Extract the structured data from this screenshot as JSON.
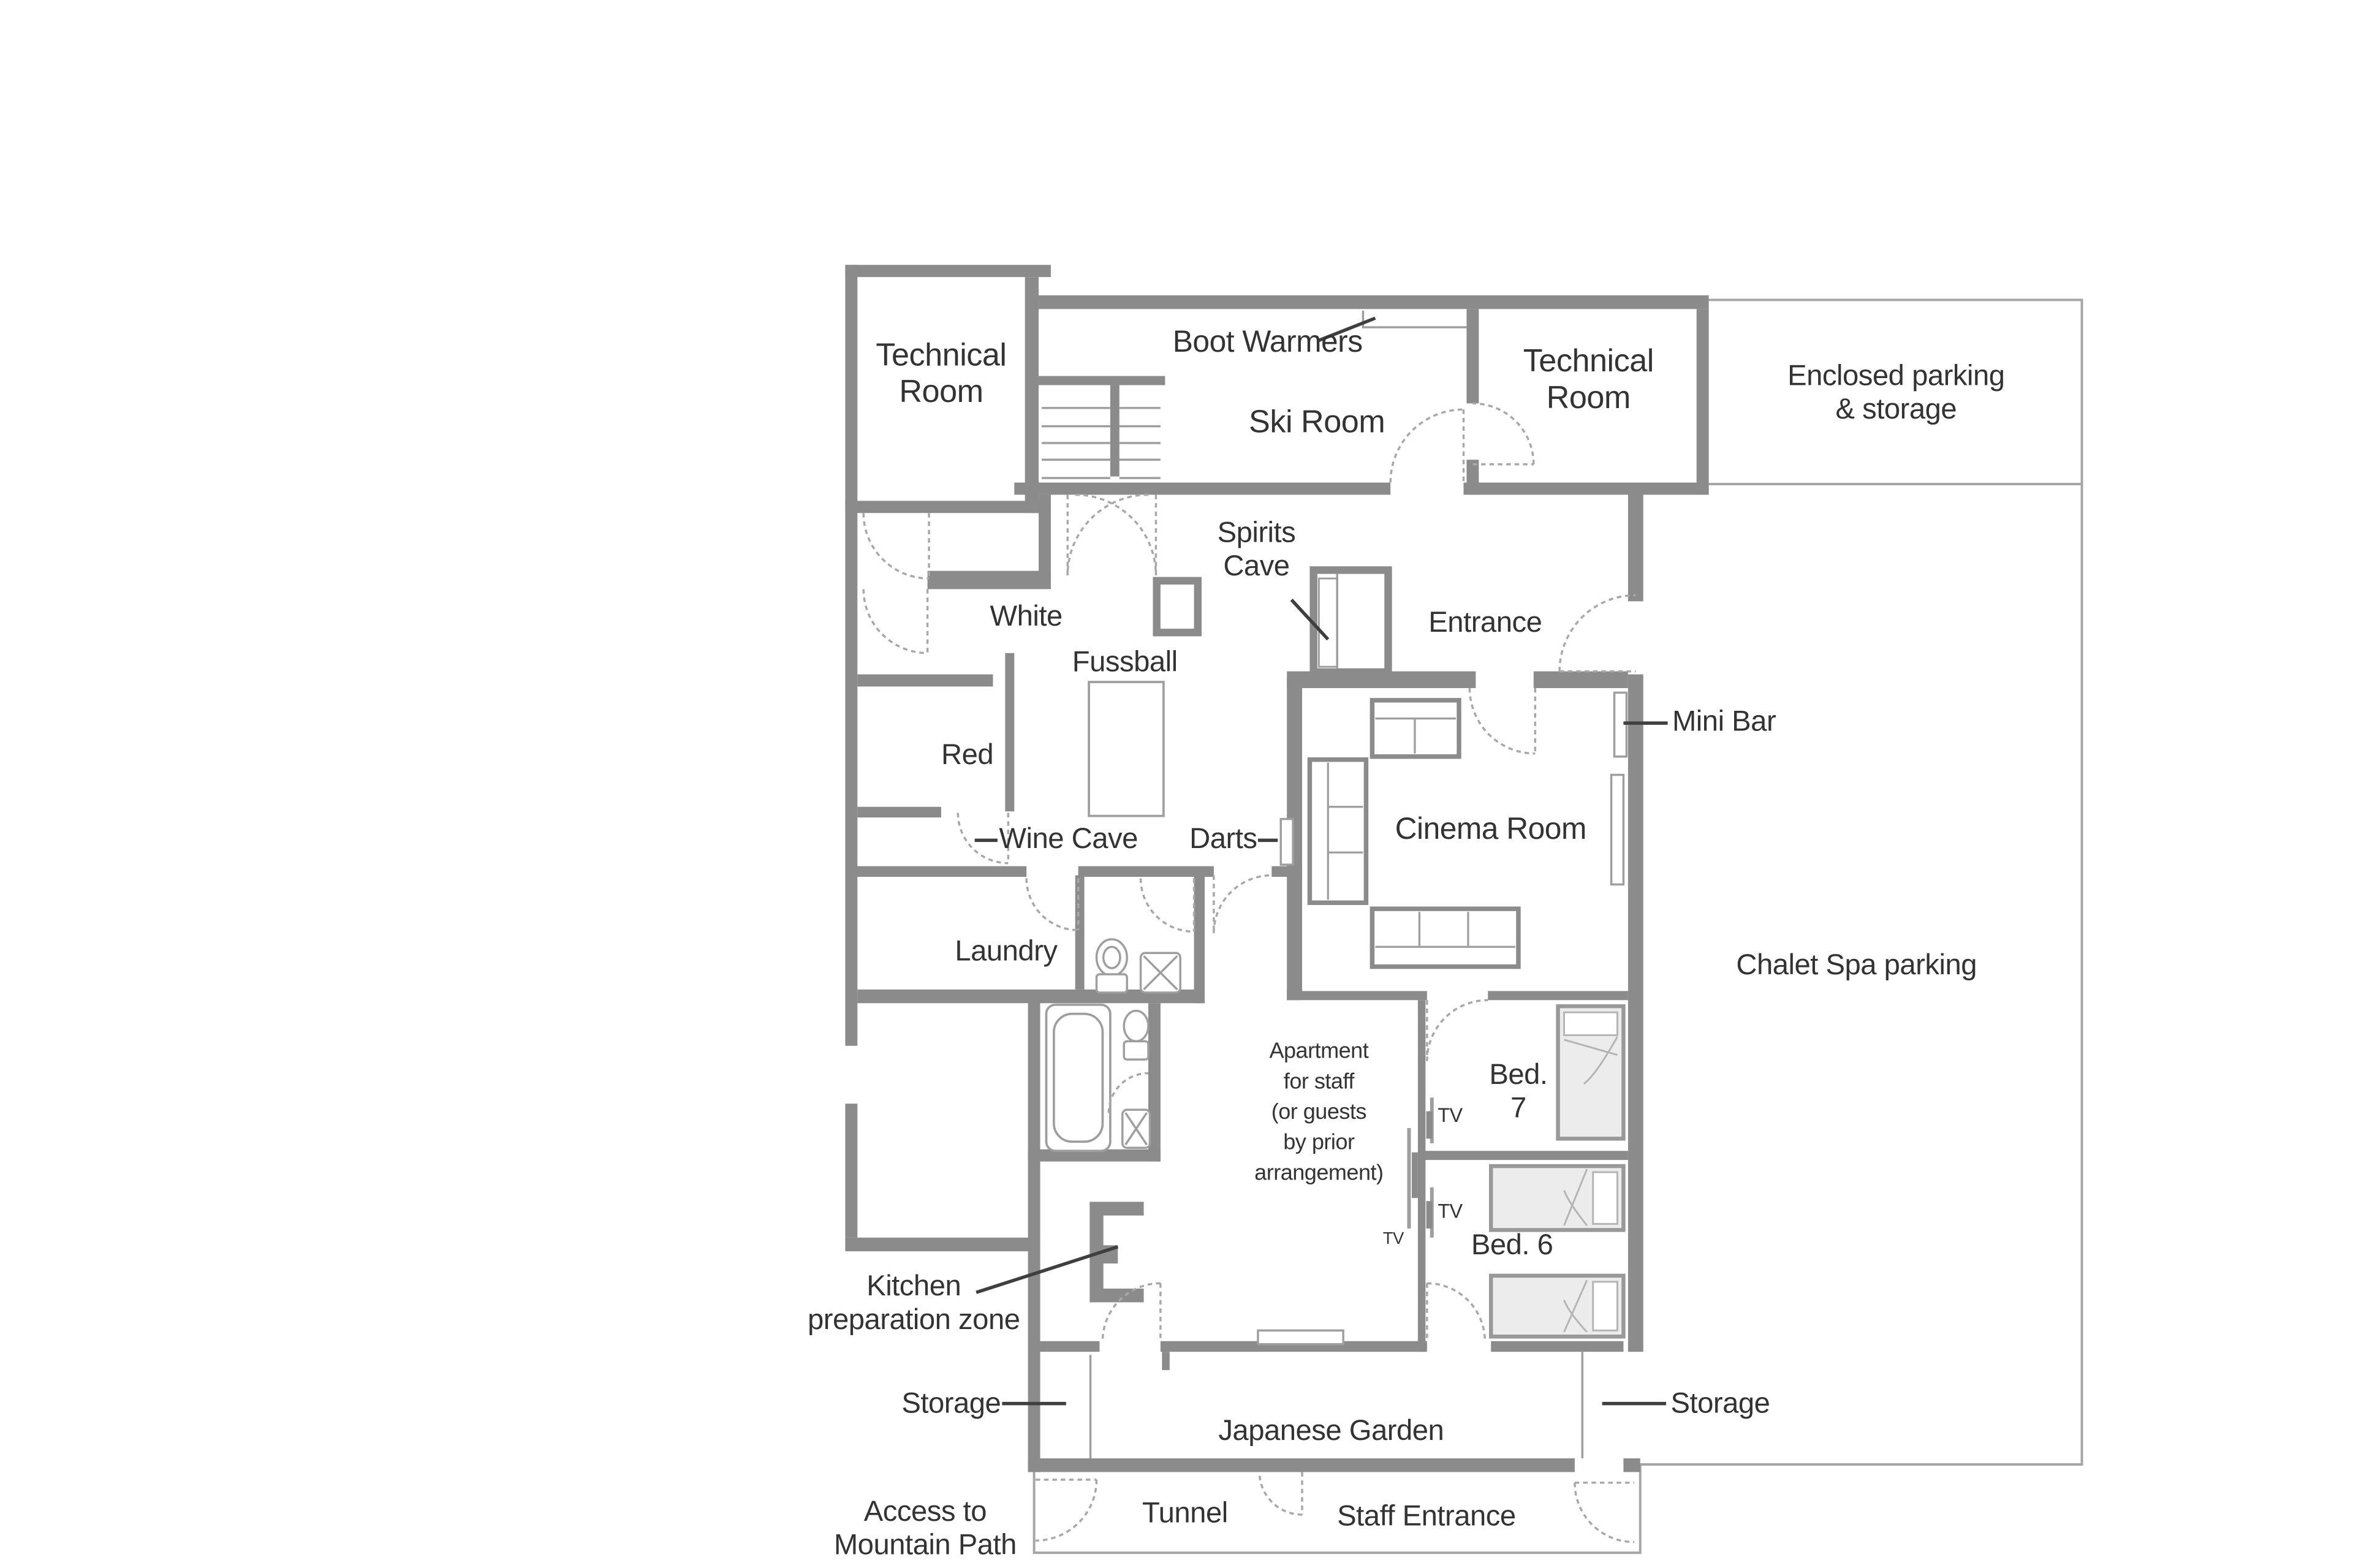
{
  "title": "Chalet lower floor plan",
  "colors": {
    "wall": "#8b8b8b",
    "thin_line": "#9e9e9e",
    "door_arc": "#a8a8a8",
    "leader": "#3f3f3f",
    "text": "#333333",
    "bed_fill": "#ececec",
    "background": "#ffffff"
  },
  "labels": {
    "technical_room_left": {
      "text": "Technical\nRoom"
    },
    "boot_warmers": {
      "text": "Boot Warmers"
    },
    "ski_room": {
      "text": "Ski Room"
    },
    "technical_room_right": {
      "text": "Technical\nRoom"
    },
    "enclosed_parking": {
      "text": "Enclosed parking\n& storage"
    },
    "spirits_cave": {
      "text": "Spirits\nCave"
    },
    "white": {
      "text": "White"
    },
    "fussball": {
      "text": "Fussball"
    },
    "entrance": {
      "text": "Entrance"
    },
    "red": {
      "text": "Red"
    },
    "mini_bar": {
      "text": "Mini Bar"
    },
    "wine_cave": {
      "text": "Wine Cave"
    },
    "darts": {
      "text": "Darts"
    },
    "cinema_room": {
      "text": "Cinema Room"
    },
    "laundry": {
      "text": "Laundry"
    },
    "chalet_spa_parking": {
      "text": "Chalet Spa parking"
    },
    "apartment": {
      "text": "Apartment\nfor staff\n(or guests\nby prior\narrangement)"
    },
    "bed_7": {
      "text": "Bed.\n7"
    },
    "tv_bed7": {
      "text": "TV"
    },
    "tv_bed6": {
      "text": "TV"
    },
    "tv_apartment": {
      "text": "TV"
    },
    "bed_6": {
      "text": "Bed. 6"
    },
    "kitchen_zone": {
      "text": "Kitchen\npreparation zone"
    },
    "storage_left": {
      "text": "Storage"
    },
    "storage_right": {
      "text": "Storage"
    },
    "japanese_garden": {
      "text": "Japanese Garden"
    },
    "access": {
      "text": "Access to\nMountain Path"
    },
    "tunnel": {
      "text": "Tunnel"
    },
    "staff_entrance": {
      "text": "Staff Entrance"
    }
  },
  "rooms": [
    "Technical Room (west)",
    "Ski Room",
    "Technical Room (east)",
    "Enclosed parking & storage",
    "Spirits Cave",
    "White",
    "Red",
    "Wine Cave",
    "Fussball hall",
    "Entrance",
    "Cinema Room",
    "Laundry",
    "W.C.",
    "Bathroom",
    "Apartment for staff",
    "Bed. 7",
    "Bed. 6",
    "Kitchen preparation zone",
    "Storage (west)",
    "Storage (east)",
    "Japanese Garden",
    "Tunnel",
    "Staff Entrance",
    "Chalet Spa parking",
    "Access to Mountain Path"
  ]
}
